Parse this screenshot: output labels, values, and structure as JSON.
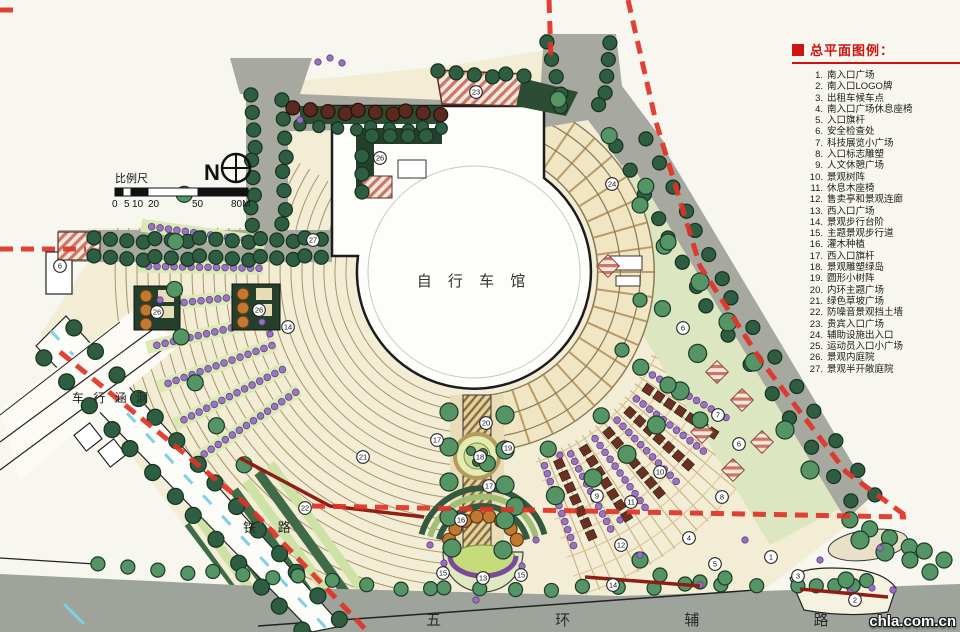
{
  "legend": {
    "title": "总平面图例：",
    "items": [
      "南入口广场",
      "南入口LOGO牌",
      "出租车候车点",
      "南入口广场休息座椅",
      "入口旗杆",
      "安全检查处",
      "科技展览小广场",
      "入口标志雕塑",
      "人文休憩广场",
      "景观树阵",
      "休息木座椅",
      "售卖亭和景观连廊",
      "西入口广场",
      "景观步行台阶",
      "主题景观步行道",
      "灌木种植",
      "西入口旗杆",
      "景观雕塑绿岛",
      "圆形小树阵",
      "内环主题广场",
      "绿色草坡广场",
      "防噪音景观挡土墙",
      "贵宾入口广场",
      "辅助设施出入口",
      "运动员入口小广场",
      "景观内庭院",
      "景观半开敞庭院"
    ]
  },
  "plan": {
    "building_label": "自 行 车 馆",
    "north_label": "N",
    "scale": {
      "label": "比例尺",
      "ticks": [
        "0",
        "5",
        "10",
        "20",
        "50",
        "80M"
      ]
    },
    "roads": {
      "bottom": "五 环 辅 路",
      "railway": "铁 路",
      "culvert": "车 行 涵 洞"
    },
    "markers": [
      {
        "n": "6",
        "x": 60,
        "y": 266
      },
      {
        "n": "23",
        "x": 476,
        "y": 92
      },
      {
        "n": "26",
        "x": 380,
        "y": 158
      },
      {
        "n": "27",
        "x": 313,
        "y": 240
      },
      {
        "n": "26",
        "x": 157,
        "y": 312
      },
      {
        "n": "26",
        "x": 259,
        "y": 310
      },
      {
        "n": "14",
        "x": 288,
        "y": 327
      },
      {
        "n": "24",
        "x": 612,
        "y": 184
      },
      {
        "n": "6",
        "x": 683,
        "y": 328
      },
      {
        "n": "7",
        "x": 718,
        "y": 415
      },
      {
        "n": "6",
        "x": 739,
        "y": 444
      },
      {
        "n": "8",
        "x": 722,
        "y": 497
      },
      {
        "n": "10",
        "x": 660,
        "y": 472
      },
      {
        "n": "9",
        "x": 597,
        "y": 496
      },
      {
        "n": "11",
        "x": 631,
        "y": 502
      },
      {
        "n": "12",
        "x": 621,
        "y": 545
      },
      {
        "n": "4",
        "x": 689,
        "y": 538
      },
      {
        "n": "5",
        "x": 715,
        "y": 564
      },
      {
        "n": "1",
        "x": 771,
        "y": 557
      },
      {
        "n": "3",
        "x": 798,
        "y": 576
      },
      {
        "n": "2",
        "x": 855,
        "y": 600
      },
      {
        "n": "14",
        "x": 613,
        "y": 585
      },
      {
        "n": "20",
        "x": 486,
        "y": 423
      },
      {
        "n": "17",
        "x": 437,
        "y": 440
      },
      {
        "n": "19",
        "x": 508,
        "y": 448
      },
      {
        "n": "18",
        "x": 480,
        "y": 457
      },
      {
        "n": "17",
        "x": 489,
        "y": 486
      },
      {
        "n": "16",
        "x": 461,
        "y": 520
      },
      {
        "n": "21",
        "x": 363,
        "y": 457
      },
      {
        "n": "22",
        "x": 305,
        "y": 508
      },
      {
        "n": "15",
        "x": 443,
        "y": 573
      },
      {
        "n": "13",
        "x": 483,
        "y": 578
      },
      {
        "n": "15",
        "x": 521,
        "y": 575
      }
    ]
  },
  "watermark": "chla.com.cn",
  "colors": {
    "legend_red": "#cc1410",
    "boundary_red": "#e03428",
    "road_gray": "#a7a8a0",
    "site_cream": "#f3edd6",
    "tree_green": "#2f5d42",
    "shrub_purple": "#9a74c0",
    "noise_wall_red": "#8e1f14"
  }
}
